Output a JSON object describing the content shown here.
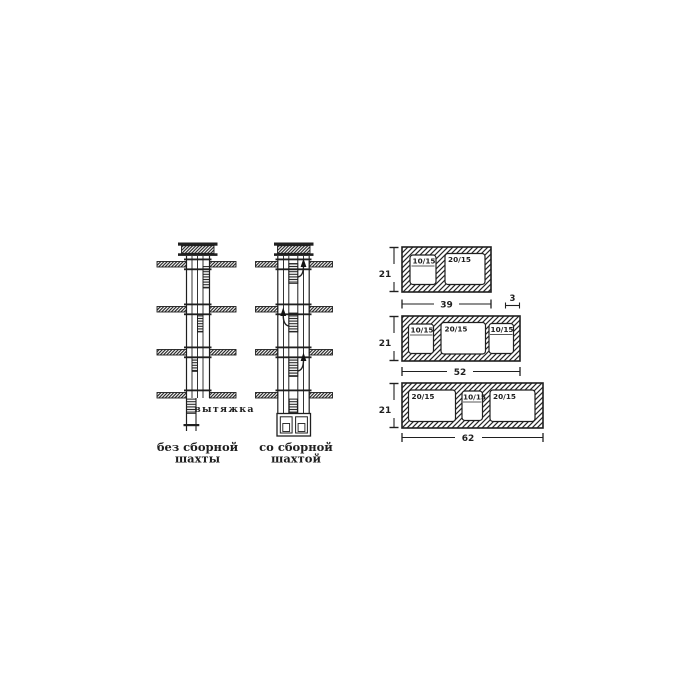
{
  "diagram": {
    "background": "#ffffff",
    "ink": "#1f1f1f",
    "shafts": {
      "exhaust_label": "вытяжка",
      "without": {
        "caption": [
          "без сборной",
          "шахты"
        ]
      },
      "with": {
        "caption": [
          "со сборной",
          "шахтой"
        ]
      }
    },
    "blocks": [
      {
        "height": "21",
        "width": "39",
        "wall_thickness": "3",
        "openings": [
          "10/15",
          "20/15"
        ]
      },
      {
        "height": "21",
        "width": "52",
        "openings": [
          "10/15",
          "20/15",
          "10/15"
        ]
      },
      {
        "height": "21",
        "width": "62",
        "openings": [
          "20/15",
          "10/15",
          "20/15"
        ]
      }
    ]
  }
}
